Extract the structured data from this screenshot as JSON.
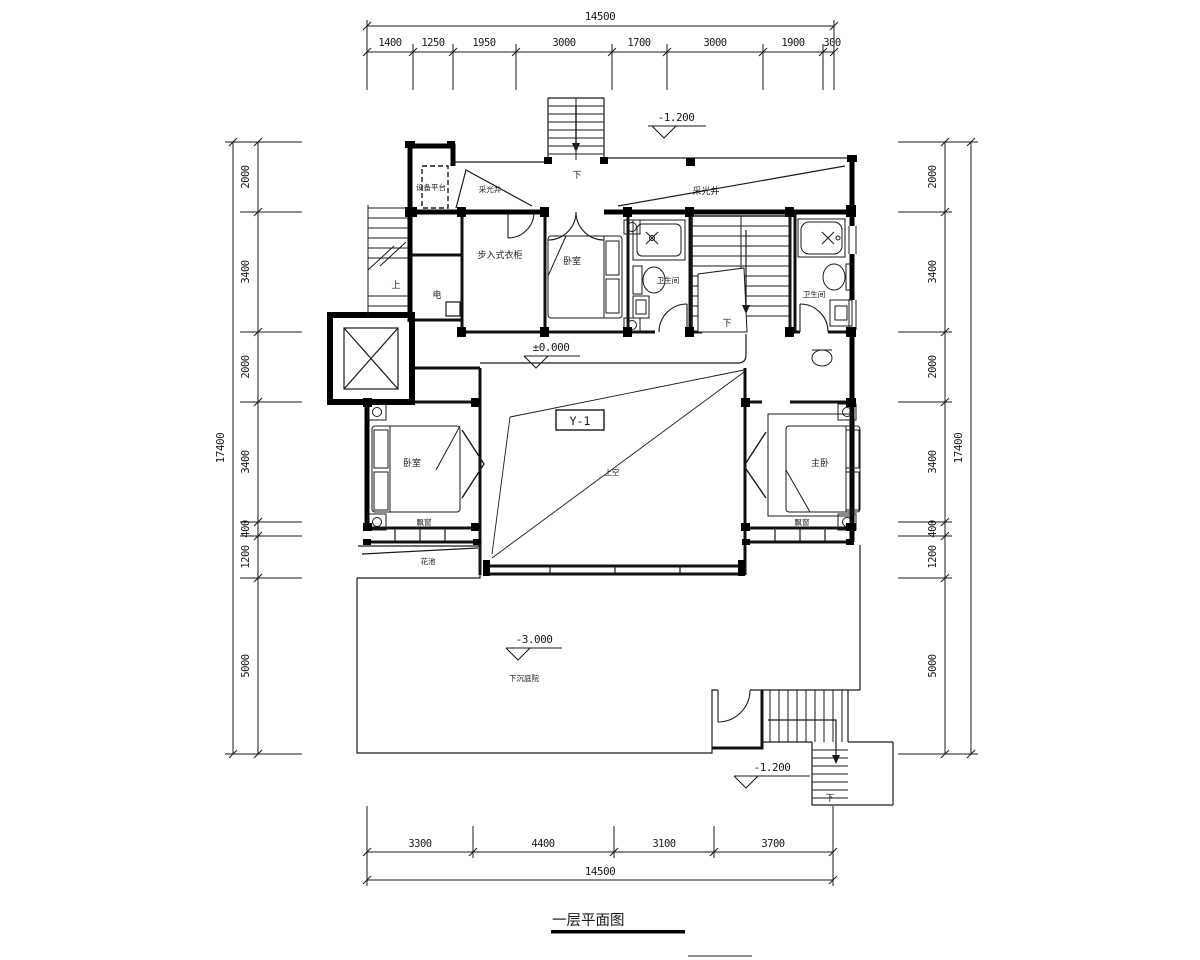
{
  "drawing_title": "一层平面图",
  "dimensions": {
    "top": {
      "total": "14500",
      "segments": [
        "1400",
        "1250",
        "1950",
        "3000",
        "1700",
        "3000",
        "1900",
        "300"
      ]
    },
    "bottom": {
      "total": "14500",
      "segments": [
        "3300",
        "4400",
        "3100",
        "3700"
      ]
    },
    "left": {
      "total": "17400",
      "segments": [
        "2000",
        "3400",
        "2000",
        "3400",
        "400",
        "1200",
        "5000"
      ]
    },
    "right": {
      "total": "17400",
      "segments": [
        "2000",
        "3400",
        "2000",
        "3400",
        "400",
        "1200",
        "5000"
      ]
    }
  },
  "elevations": {
    "north_entry": "-1.200",
    "main_floor": "±0.000",
    "courtyard": "-3.000",
    "south_entry": "-1.200"
  },
  "rooms": {
    "equipment_platform": "设备平台",
    "light_well_west": "采光井",
    "light_well_north": "采光井",
    "walk_in_closet": "步入式衣柜",
    "bedroom_north": "卧室",
    "bathroom_west": "卫生间",
    "bathroom_east": "卫生间",
    "electrical_shaft": "电",
    "bedroom_west": "卧室",
    "master_bedroom": "主卧",
    "void_above": "上空",
    "bay_window_west": "飘窗",
    "bay_window_east": "飘窗",
    "planter": "花池",
    "sunken_courtyard": "下沉庭院"
  },
  "stair_marks": {
    "up_west": "上",
    "down_north": "下",
    "down_center": "下",
    "down_south": "下"
  },
  "tags": {
    "beam_tag": "Y-1"
  },
  "colors": {
    "line": "#1a1a1a",
    "background": "#ffffff"
  }
}
